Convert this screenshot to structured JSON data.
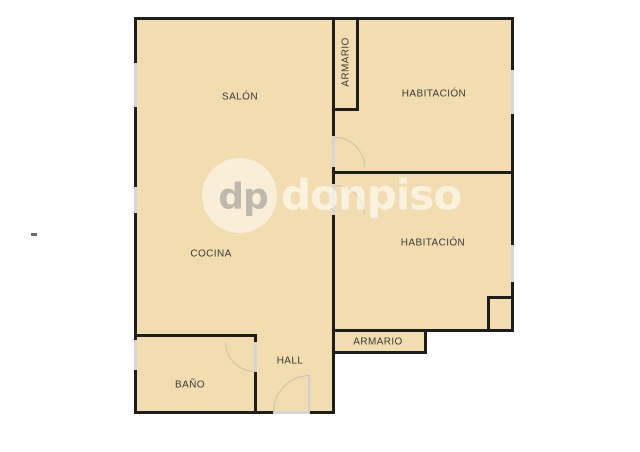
{
  "plan": {
    "rooms": {
      "salon": {
        "label": "SALÓN"
      },
      "armario_top": {
        "label": "ARMARIO"
      },
      "habitacion_top": {
        "label": "HABITACIÓN"
      },
      "habitacion_bottom": {
        "label": "HABITACIÓN"
      },
      "cocina": {
        "label": "COCINA"
      },
      "hall": {
        "label": "HALL"
      },
      "armario_bottom": {
        "label": "ARMARIO"
      },
      "bano": {
        "label": "BAÑO"
      }
    }
  },
  "watermark": {
    "initials": "dp",
    "name": "donpiso"
  },
  "colors": {
    "background": "#ffffff",
    "room_fill": "#f2ddb1",
    "wall": "#1d1d1b",
    "opening": "#d6d6d6",
    "door_arc": "#cbc2ac",
    "label_text": "#3a3a38",
    "watermark_text": "rgba(255,255,255,0.58)",
    "watermark_initials": "#b5b0a6"
  }
}
